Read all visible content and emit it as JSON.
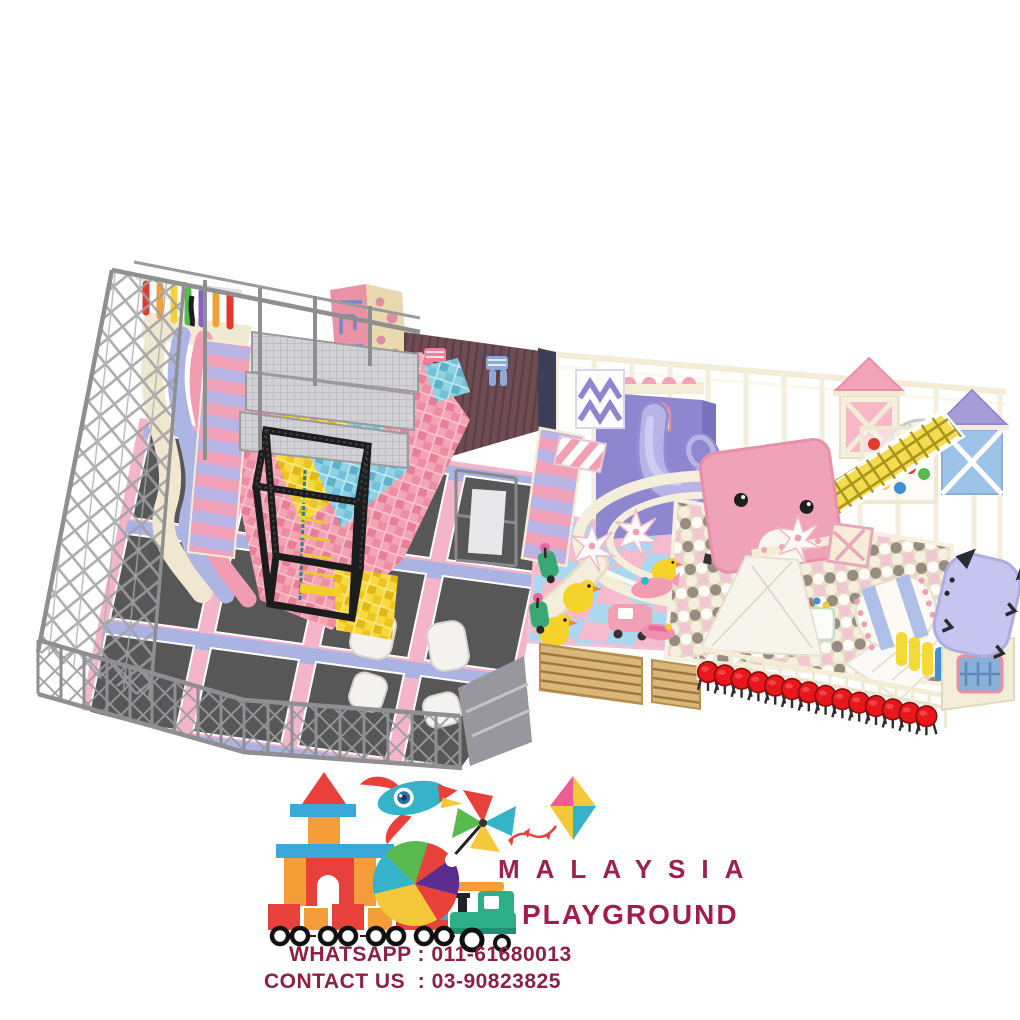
{
  "page": {
    "background": "#ffffff",
    "description": "3D render of a pastel indoor playground: left trampoline park with foam cube pit inside a steel cage, right candy-pink soft play castle with ball pit, and Malaysia Playground brand logo with contact numbers"
  },
  "brand": {
    "name": "MALAYSIA",
    "tagline": "PLAYGROUND",
    "name_color": "#9b2150",
    "tagline_color": "#a01e4d"
  },
  "contact": {
    "whatsapp": "WHATSAPP : 011-61680013",
    "contact_us": "CONTACT US  : 03-90823825",
    "text_color": "#8d2045"
  },
  "logo": {
    "icons": [
      "building-blocks-castle",
      "rocket",
      "pinwheel",
      "kite",
      "beach-ball",
      "toy-train"
    ]
  },
  "scene": {
    "zones": [
      {
        "id": "trampoline-park",
        "label": "Trampoline park with foam cube pit",
        "features": [
          "steel-safety-cage",
          "rainbow-ninja-bars",
          "wavy-slides",
          "pink-roller-ramp",
          "steel-mesh-platforms",
          "foam-cube-pit",
          "maze-climbing-wall",
          "camo-climbing-wall",
          "pajama-decor-wall",
          "black-truss-tower",
          "trampoline-grid",
          "landing-airbags",
          "gray-service-platform"
        ]
      },
      {
        "id": "soft-play",
        "label": "Pastel soft play castle",
        "features": [
          "cream-frame-posts",
          "purple-castle-wall",
          "spiral-tube-slide",
          "round-balcony",
          "roller-stairs",
          "chevron-panel",
          "striped-awning",
          "pink-turret",
          "purple-turret",
          "net-dome",
          "rainbow-ball-cage",
          "yellow-climb-net",
          "kitten-face-slide-tower",
          "white-wide-slides",
          "pastel-ball-pit",
          "rolling-barrel",
          "yellow-rollers",
          "checker-play-mat",
          "toy-ducks",
          "toy-scooters",
          "toy-car",
          "seesaw-toys",
          "spike-palm-trees",
          "front-fence",
          "red-stools",
          "cat-face-slide",
          "wooden-slat-benches"
        ]
      }
    ],
    "stool_count": 14,
    "palette": {
      "steel": "#9a9a9a",
      "truss_black": "#1d1d1d",
      "mat_dark": "#575757",
      "pad_pink": "#f4b4ca",
      "pad_lavender": "#aab3e2",
      "cream": "#f3ecd7",
      "foam_pink": "#ee8ca1",
      "foam_yellow": "#f0cc2e",
      "foam_blue": "#74c2d8",
      "wall_brown": "#6f4c54",
      "castle_purple": "#8e86ce",
      "tube_lavender": "#b9b4e6",
      "net_yellow": "#f2dd4e",
      "kitten_pink": "#f0a3b8",
      "ball_cream": "#f7efdd",
      "ball_pink": "#f3c6d4",
      "ball_gray": "#978c80",
      "floor_pink": "#f5bace",
      "floor_blue": "#abd8f0",
      "stool_red": "#e7171c",
      "bench_tan": "#d9b778",
      "cat_lavender": "#c6c5f0"
    }
  }
}
